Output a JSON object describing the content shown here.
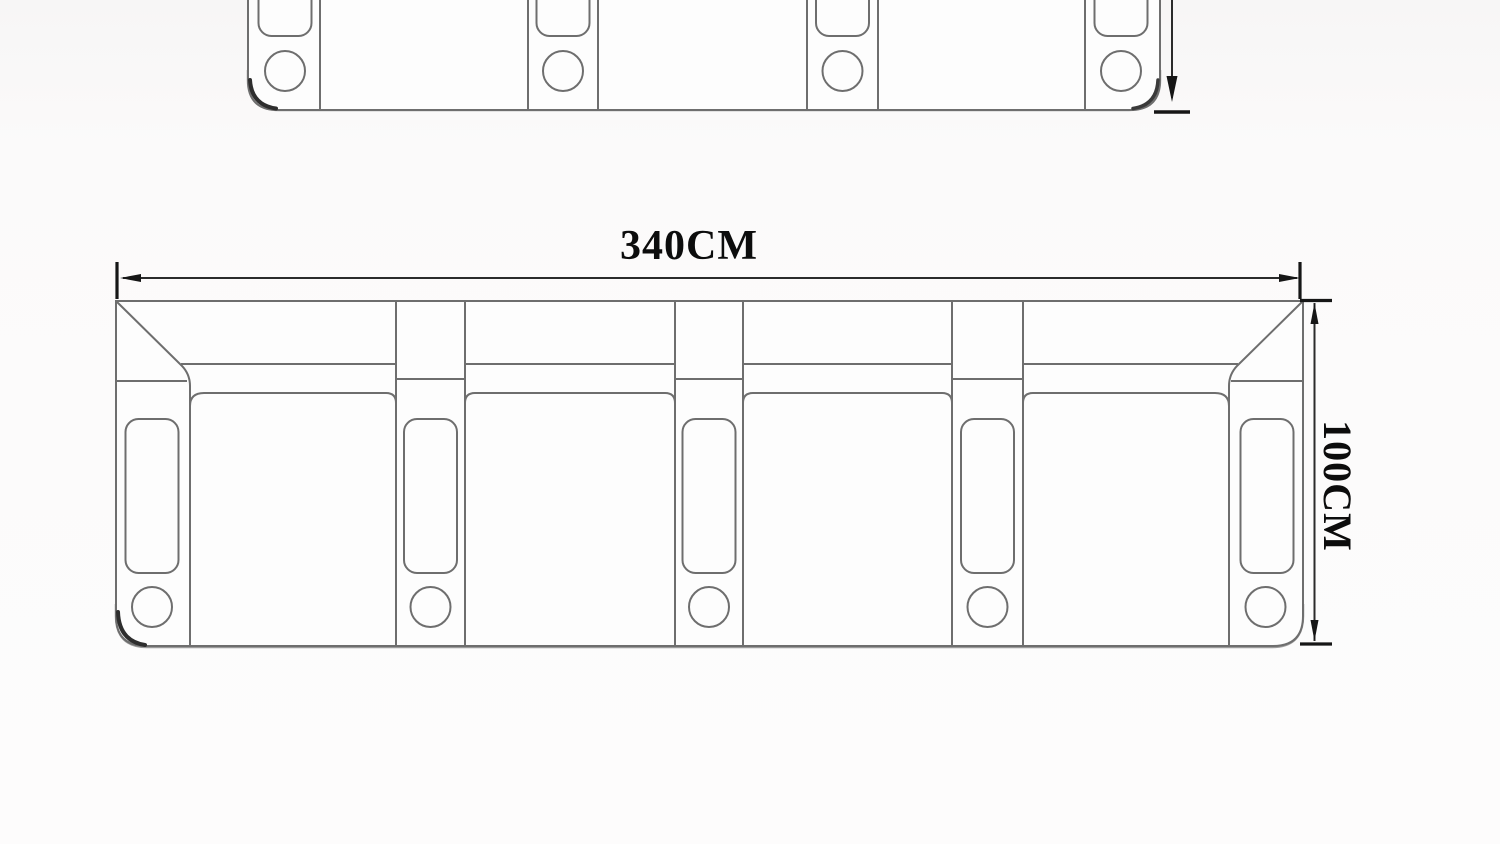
{
  "diagram": {
    "labels": {
      "width": "340CM",
      "height": "100CM"
    },
    "colors": {
      "background": "#fbfafa",
      "sofa_fill": "#fdfdfd",
      "outline": "#6e6e6e",
      "bottom_edge": "#9b9b9b",
      "corner_accent": "#2e2e2e",
      "dimension_line": "#2b2b2b",
      "dimension_marker": "#161616",
      "label_text": "#0c0c0c"
    }
  }
}
